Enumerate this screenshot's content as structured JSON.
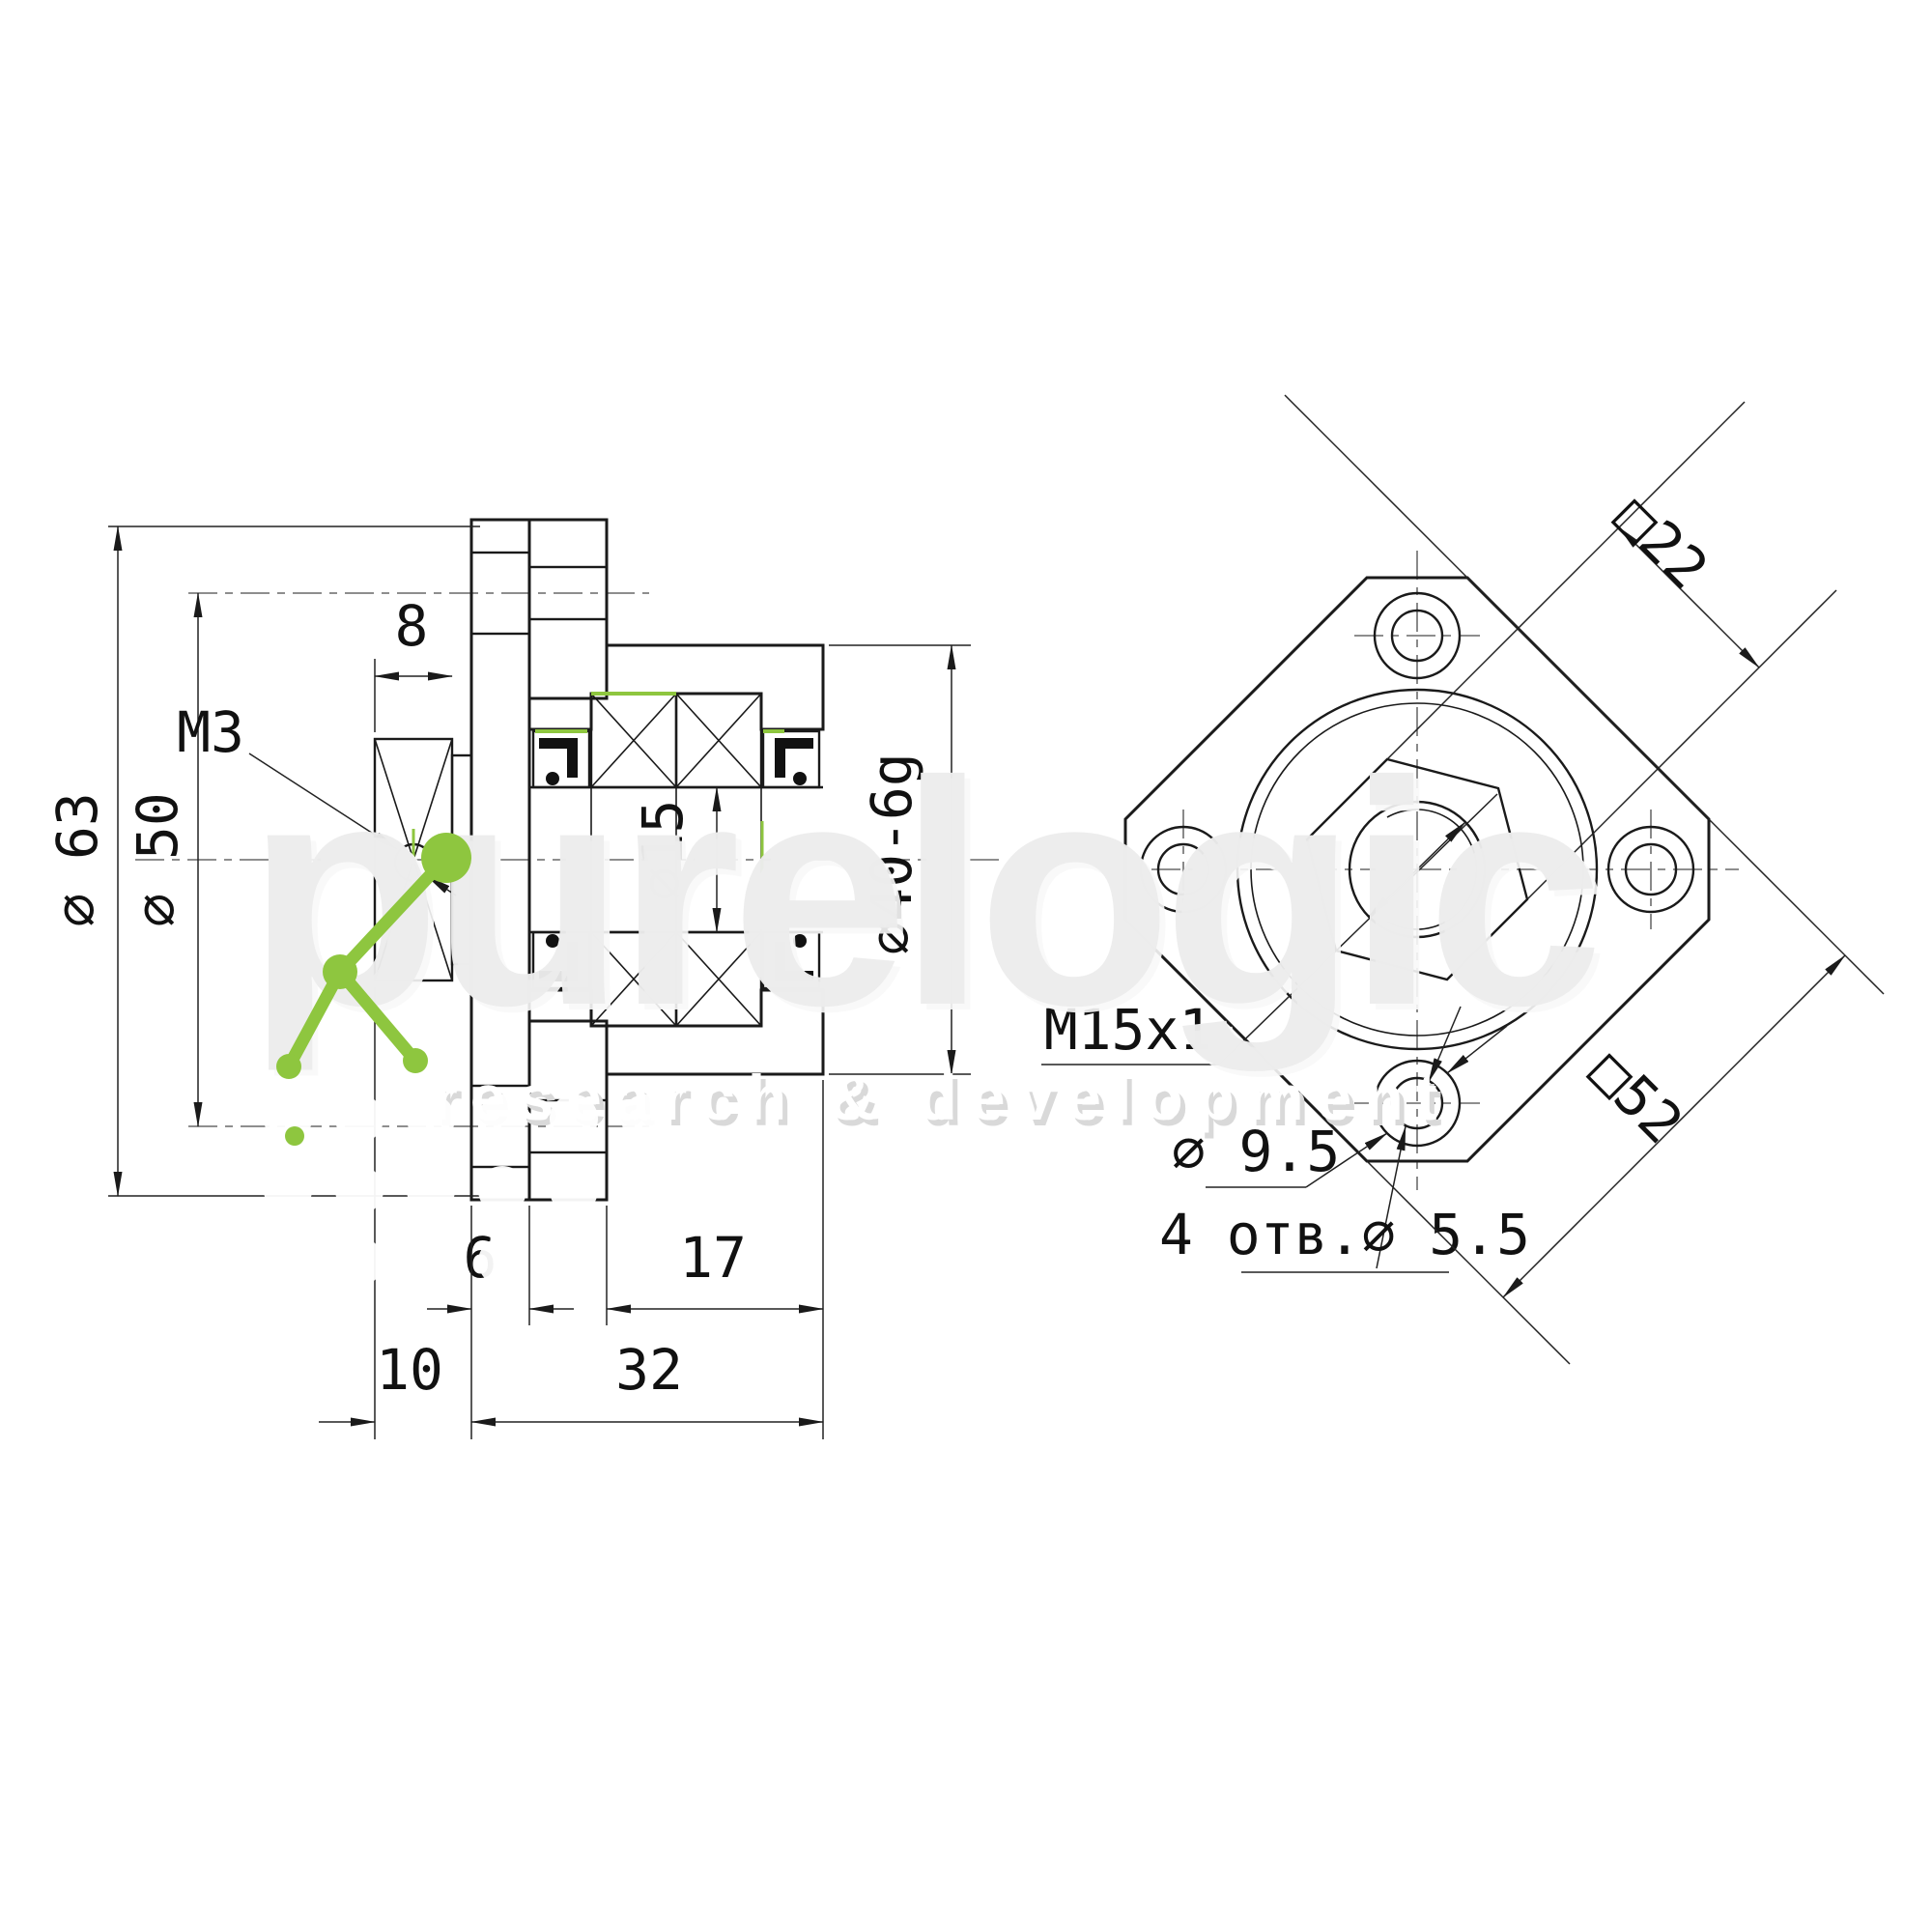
{
  "drawing_type": "ballscrew-support-unit-technical-drawing",
  "labels": {
    "dia63": "⌀ 63",
    "dia50": "⌀ 50",
    "width8": "8",
    "m3": "M3",
    "dia15": "⌀15",
    "dia40": "⌀40-6g",
    "thick6": "6",
    "len17": "17",
    "len10": "10",
    "len32": "32",
    "sq22": "□22",
    "sq52": "□52",
    "thread": "M15x1",
    "dia95": "⌀ 9.5",
    "holes4": "4 отв.⌀ 5.5"
  },
  "watermark": {
    "brand": "purelogic",
    "tagline": "research & development"
  },
  "colors": {
    "line": "#1a1a1a",
    "accent_green": "#8ec63f",
    "watermark_gray": "#ececec"
  }
}
